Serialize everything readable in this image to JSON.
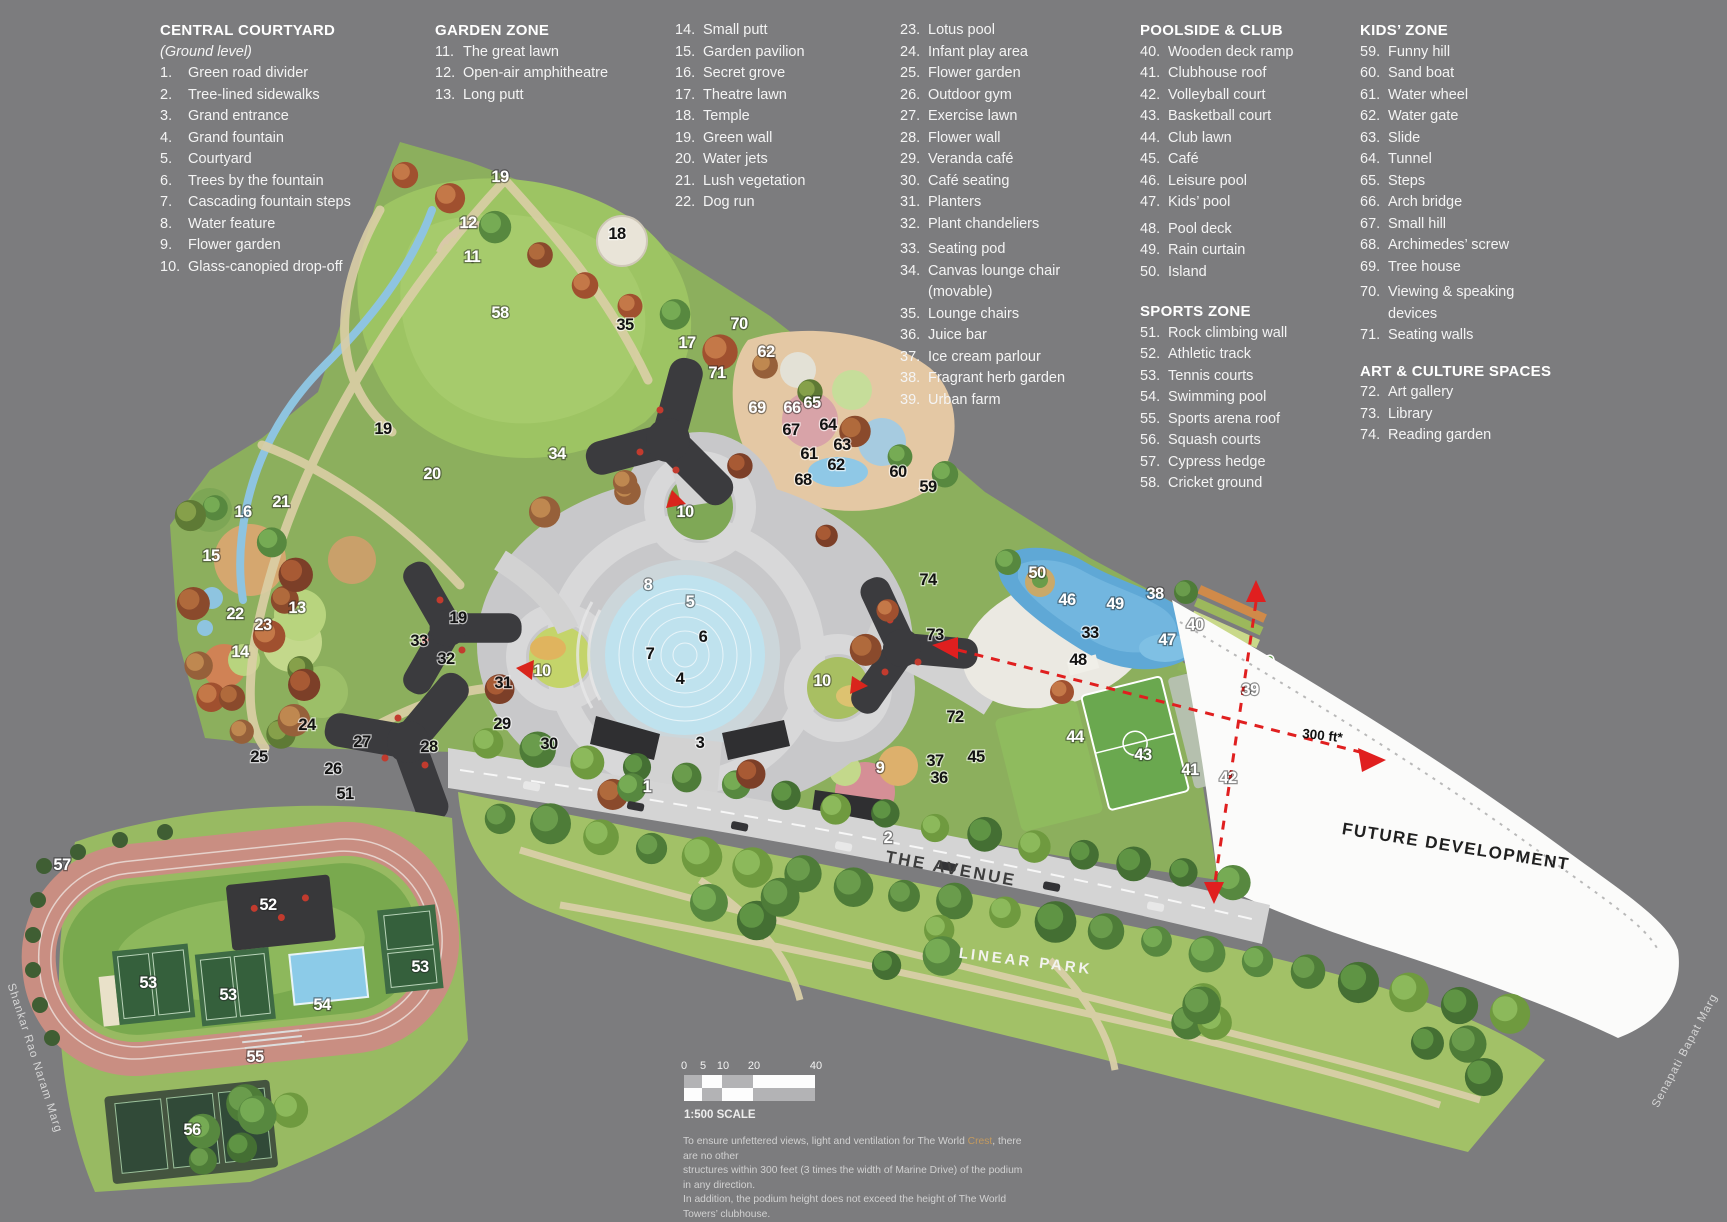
{
  "legend": {
    "columns": [
      {
        "x": 160,
        "blocks": [
          {
            "h": "CENTRAL COURTYARD"
          },
          {
            "s": "(Ground level)"
          },
          {
            "n": "1.",
            "t": "Green road divider"
          },
          {
            "n": "2.",
            "t": "Tree-lined sidewalks"
          },
          {
            "n": "3.",
            "t": "Grand entrance"
          },
          {
            "n": "4.",
            "t": "Grand fountain"
          },
          {
            "n": "5.",
            "t": "Courtyard"
          },
          {
            "n": "6.",
            "t": "Trees by the fountain"
          },
          {
            "n": "7.",
            "t": "Cascading fountain steps"
          },
          {
            "n": "8.",
            "t": "Water feature"
          },
          {
            "n": "9.",
            "t": "Flower garden"
          },
          {
            "n": "10.",
            "t": "Glass-canopied drop-off"
          }
        ]
      },
      {
        "x": 435,
        "blocks": [
          {
            "h": "GARDEN ZONE"
          },
          {
            "n": "11.",
            "t": "The great lawn"
          },
          {
            "n": "12.",
            "t": "Open-air amphitheatre"
          },
          {
            "n": "13.",
            "t": "Long putt"
          }
        ]
      },
      {
        "x": 675,
        "blocks": [
          {
            "n": "14.",
            "t": "Small putt"
          },
          {
            "n": "15.",
            "t": "Garden pavilion"
          },
          {
            "n": "16.",
            "t": "Secret grove"
          },
          {
            "n": "17.",
            "t": "Theatre lawn"
          },
          {
            "n": "18.",
            "t": "Temple"
          },
          {
            "n": "19.",
            "t": "Green wall"
          },
          {
            "n": "20.",
            "t": "Water jets"
          },
          {
            "n": "21.",
            "t": "Lush vegetation"
          },
          {
            "n": "22.",
            "t": "Dog run"
          }
        ]
      },
      {
        "x": 900,
        "blocks": [
          {
            "n": "23.",
            "t": "Lotus pool"
          },
          {
            "n": "24.",
            "t": "Infant play area"
          },
          {
            "n": "25.",
            "t": "Flower garden"
          },
          {
            "n": "26.",
            "t": "Outdoor gym"
          },
          {
            "n": "27.",
            "t": "Exercise lawn"
          },
          {
            "n": "28.",
            "t": "Flower wall"
          },
          {
            "n": "29.",
            "t": "Veranda café"
          },
          {
            "n": "30.",
            "t": "Café seating"
          },
          {
            "n": "31.",
            "t": "Planters"
          },
          {
            "n": "32.",
            "t": "Plant chandeliers"
          },
          {
            "g": 4
          },
          {
            "n": "33.",
            "t": "Seating pod"
          },
          {
            "n": "34.",
            "t": "Canvas lounge chair",
            "t2": "(movable)"
          },
          {
            "n": "35.",
            "t": "Lounge chairs"
          },
          {
            "n": "36.",
            "t": "Juice bar"
          },
          {
            "n": "37.",
            "t": "Ice cream parlour"
          },
          {
            "n": "38.",
            "t": "Fragrant herb garden"
          },
          {
            "n": "39.",
            "t": "Urban farm"
          }
        ]
      },
      {
        "x": 1140,
        "blocks": [
          {
            "h": "POOLSIDE & CLUB"
          },
          {
            "n": "40.",
            "t": "Wooden deck ramp"
          },
          {
            "n": "41.",
            "t": "Clubhouse roof"
          },
          {
            "n": "42.",
            "t": "Volleyball court"
          },
          {
            "n": "43.",
            "t": "Basketball court"
          },
          {
            "n": "44.",
            "t": "Club lawn"
          },
          {
            "n": "45.",
            "t": "Café"
          },
          {
            "n": "46.",
            "t": "Leisure pool"
          },
          {
            "n": "47.",
            "t": "Kids’ pool"
          },
          {
            "g": 5
          },
          {
            "n": "48.",
            "t": "Pool deck"
          },
          {
            "n": "49.",
            "t": "Rain curtain"
          },
          {
            "n": "50.",
            "t": "Island"
          },
          {
            "h": "SPORTS ZONE",
            "top": 18
          },
          {
            "n": "51.",
            "t": "Rock climbing wall"
          },
          {
            "n": "52.",
            "t": "Athletic track"
          },
          {
            "n": "53.",
            "t": "Tennis courts"
          },
          {
            "n": "54.",
            "t": "Swimming pool"
          },
          {
            "n": "55.",
            "t": "Sports arena roof"
          },
          {
            "n": "56.",
            "t": "Squash courts"
          },
          {
            "n": "57.",
            "t": "Cypress hedge"
          },
          {
            "n": "58.",
            "t": "Cricket ground"
          }
        ]
      },
      {
        "x": 1360,
        "blocks": [
          {
            "h": "KIDS’ ZONE"
          },
          {
            "n": "59.",
            "t": "Funny hill"
          },
          {
            "n": "60.",
            "t": "Sand boat"
          },
          {
            "n": "61.",
            "t": "Water wheel"
          },
          {
            "n": "62.",
            "t": "Water gate"
          },
          {
            "n": "63.",
            "t": "Slide"
          },
          {
            "n": "64.",
            "t": "Tunnel"
          },
          {
            "n": "65.",
            "t": "Steps"
          },
          {
            "n": "66.",
            "t": "Arch bridge"
          },
          {
            "n": "67.",
            "t": "Small hill"
          },
          {
            "n": "68.",
            "t": "Archimedes’ screw"
          },
          {
            "n": "69.",
            "t": "Tree house"
          },
          {
            "g": 4
          },
          {
            "n": "70.",
            "t": "Viewing & speaking",
            "t2": "devices"
          },
          {
            "n": "71.",
            "t": "Seating walls"
          },
          {
            "h": "ART & CULTURE SPACES",
            "top": 14
          },
          {
            "n": "72.",
            "t": "Art gallery"
          },
          {
            "n": "73.",
            "t": "Library"
          },
          {
            "n": "74.",
            "t": "Reading garden"
          }
        ]
      }
    ]
  },
  "map": {
    "labels": {
      "avenue": "THE AVENUE",
      "linear_park": "LINEAR PARK",
      "future_development": "FUTURE DEVELOPMENT",
      "distance_note": "300 ft*",
      "street_left": "Shankar Rao Naram Marg",
      "street_right": "Senapati Bapat Marg"
    },
    "markers": [
      [
        "19",
        500,
        182,
        1
      ],
      [
        "12",
        468,
        228,
        1
      ],
      [
        "18",
        617,
        239,
        0
      ],
      [
        "11",
        472,
        262,
        1
      ],
      [
        "58",
        500,
        318,
        1
      ],
      [
        "35",
        625,
        330,
        0
      ],
      [
        "17",
        687,
        348,
        1
      ],
      [
        "70",
        739,
        329,
        1
      ],
      [
        "62",
        766,
        357,
        1
      ],
      [
        "71",
        717,
        378,
        1
      ],
      [
        "69",
        757,
        413,
        1
      ],
      [
        "66",
        792,
        413,
        1
      ],
      [
        "65",
        812,
        408,
        1
      ],
      [
        "64",
        828,
        430,
        0
      ],
      [
        "67",
        791,
        435,
        0
      ],
      [
        "61",
        809,
        459,
        0
      ],
      [
        "63",
        842,
        450,
        0
      ],
      [
        "62",
        836,
        470,
        0
      ],
      [
        "68",
        803,
        485,
        0
      ],
      [
        "60",
        898,
        477,
        0
      ],
      [
        "59",
        928,
        492,
        0
      ],
      [
        "19",
        383,
        434,
        0
      ],
      [
        "20",
        432,
        479,
        1
      ],
      [
        "34",
        557,
        459,
        1
      ],
      [
        "16",
        243,
        517,
        1
      ],
      [
        "21",
        281,
        507,
        1
      ],
      [
        "15",
        211,
        561,
        1
      ],
      [
        "13",
        297,
        613,
        1
      ],
      [
        "22",
        235,
        619,
        1
      ],
      [
        "23",
        263,
        630,
        1
      ],
      [
        "14",
        240,
        657,
        1
      ],
      [
        "19",
        458,
        623,
        0
      ],
      [
        "33",
        419,
        646,
        0
      ],
      [
        "32",
        446,
        664,
        0
      ],
      [
        "31",
        503,
        688,
        0
      ],
      [
        "10",
        542,
        676,
        1
      ],
      [
        "30",
        549,
        749,
        0
      ],
      [
        "28",
        429,
        752,
        0
      ],
      [
        "24",
        307,
        730,
        0
      ],
      [
        "27",
        362,
        747,
        0
      ],
      [
        "25",
        259,
        762,
        0
      ],
      [
        "26",
        333,
        774,
        0
      ],
      [
        "51",
        345,
        799,
        0
      ],
      [
        "29",
        502,
        729,
        0
      ],
      [
        "10",
        685,
        517,
        1
      ],
      [
        "8",
        648,
        590,
        1
      ],
      [
        "5",
        690,
        607,
        1
      ],
      [
        "6",
        703,
        642,
        0
      ],
      [
        "7",
        650,
        659,
        0
      ],
      [
        "4",
        680,
        684,
        0
      ],
      [
        "10",
        822,
        686,
        1
      ],
      [
        "9",
        880,
        773,
        1
      ],
      [
        "37",
        935,
        766,
        0
      ],
      [
        "36",
        939,
        783,
        0
      ],
      [
        "45",
        976,
        762,
        0
      ],
      [
        "3",
        700,
        748,
        0
      ],
      [
        "1",
        647,
        792,
        1
      ],
      [
        "2",
        888,
        843,
        1
      ],
      [
        "50",
        1037,
        578,
        1
      ],
      [
        "46",
        1067,
        605,
        1
      ],
      [
        "49",
        1115,
        609,
        1
      ],
      [
        "33",
        1090,
        638,
        0
      ],
      [
        "47",
        1167,
        645,
        1
      ],
      [
        "48",
        1078,
        665,
        0
      ],
      [
        "38",
        1155,
        599,
        1
      ],
      [
        "40",
        1195,
        630,
        1
      ],
      [
        "74",
        928,
        585,
        0
      ],
      [
        "73",
        935,
        640,
        0
      ],
      [
        "72",
        955,
        722,
        0
      ],
      [
        "44",
        1075,
        742,
        1
      ],
      [
        "43",
        1143,
        760,
        1
      ],
      [
        "41",
        1190,
        775,
        1
      ],
      [
        "42",
        1228,
        783,
        1
      ],
      [
        "39",
        1250,
        695,
        1
      ],
      [
        "57",
        62,
        870,
        1
      ],
      [
        "52",
        268,
        910,
        1
      ],
      [
        "53",
        148,
        988,
        1
      ],
      [
        "53",
        228,
        1000,
        1
      ],
      [
        "53",
        420,
        972,
        1
      ],
      [
        "54",
        322,
        1010,
        1
      ],
      [
        "55",
        255,
        1062,
        1
      ],
      [
        "56",
        192,
        1135,
        1
      ]
    ]
  },
  "scale_bar": {
    "ticks": [
      "0",
      "5",
      "10",
      "20",
      "40"
    ],
    "label": "1:500 SCALE"
  },
  "disclaimer": {
    "line1_pre": "To ensure unfettered views, light and ventilation for The World ",
    "line1_highlight": "Crest",
    "line1_post": ", there are no other",
    "line2": "structures within 300 feet (3 times the width of Marine Drive) of the podium in any direction.",
    "line3": "In addition, the podium height does not exceed the height of The World Towers’ clubhouse.",
    "highlight_color": "#c49a5e"
  }
}
